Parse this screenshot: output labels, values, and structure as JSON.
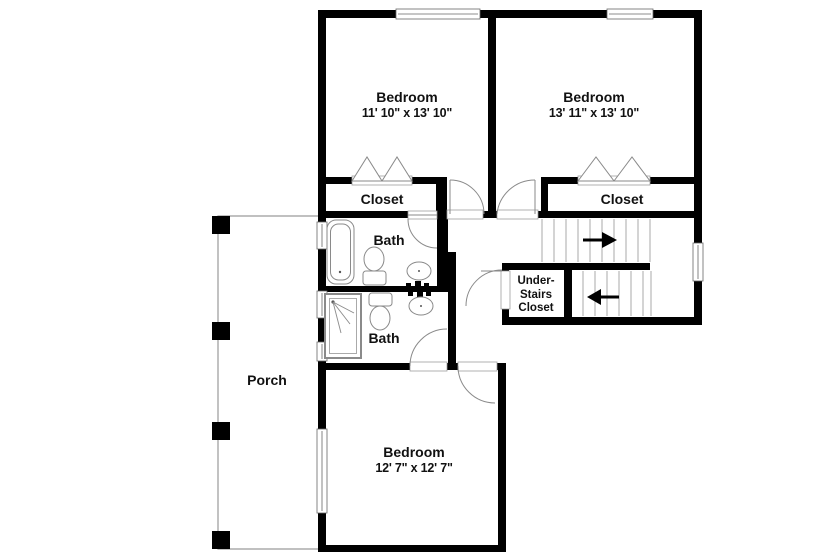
{
  "plan_labels": {
    "bedroom_top_left": {
      "name": "Bedroom",
      "dims": "11' 10\" x 13' 10\""
    },
    "bedroom_top_right": {
      "name": "Bedroom",
      "dims": "13' 11\" x 13' 10\""
    },
    "bedroom_bottom": {
      "name": "Bedroom",
      "dims": "12' 7\" x 12' 7\""
    },
    "closet_left": "Closet",
    "closet_right": "Closet",
    "bath_upper": "Bath",
    "bath_lower": "Bath",
    "under_stairs": {
      "line1": "Under-",
      "line2": "Stairs",
      "line3": "Closet"
    },
    "porch": "Porch"
  },
  "colors": {
    "wall": "#000000",
    "background": "#ffffff",
    "fixture_outline": "#8a8a8a",
    "stair_line": "#aaaaaa",
    "text": "#111111"
  }
}
